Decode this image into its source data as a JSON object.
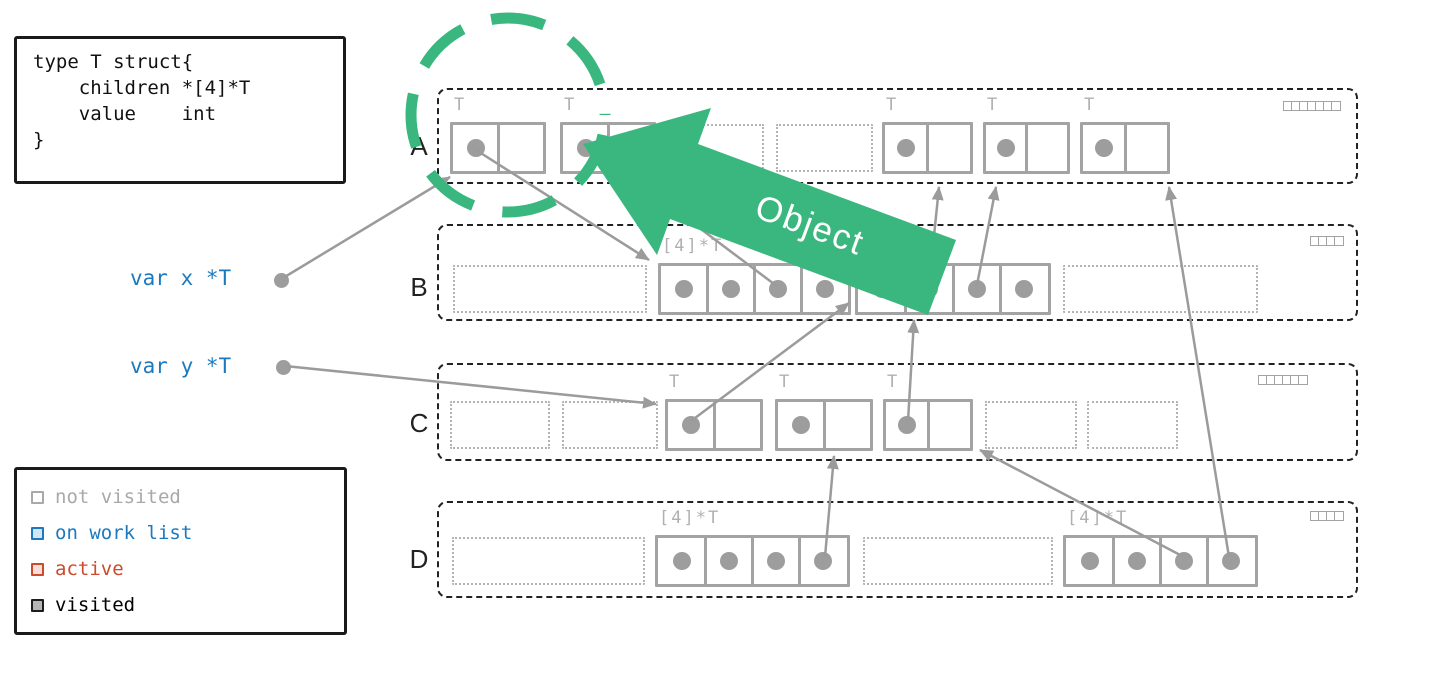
{
  "colors": {
    "green": "#3ab77e",
    "gray_line": "#9b9b9b",
    "gray_box": "#a3a3a3",
    "gray_label": "#b0b0b0",
    "blue": "#1b79c0",
    "red": "#cd4a2d",
    "ink": "#1a1a1a"
  },
  "code_block": {
    "text": "type T struct{\n    children *[4]*T\n    value    int\n}"
  },
  "legend": {
    "items": [
      {
        "label": "not visited",
        "border": "#a9a9a9",
        "fill": "#ffffff",
        "text_color": "#a9a9a9"
      },
      {
        "label": "on work list",
        "border": "#1b79c0",
        "fill": "#d3e4f2",
        "text_color": "#1b79c0"
      },
      {
        "label": "active",
        "border": "#cd4a2d",
        "fill": "#f7ded7",
        "text_color": "#cd4a2d"
      },
      {
        "label": "visited",
        "border": "#1d1d1d",
        "fill": "#b5b5b5",
        "text_color": "#000000"
      }
    ]
  },
  "stack_vars": [
    {
      "label": "var x *T",
      "label_pos": [
        130,
        266
      ],
      "dot": [
        281,
        280
      ]
    },
    {
      "label": "var y *T",
      "label_pos": [
        130,
        354
      ],
      "dot": [
        283,
        367
      ]
    }
  ],
  "object_arrow": {
    "label": "Object",
    "color": "#3ab77e"
  },
  "spans": [
    {
      "id": "A",
      "label": "A",
      "x": 437,
      "y": 88,
      "w": 921,
      "h": 96,
      "obj_y": 122,
      "bitmap_cells": 7,
      "bitmap_pos": [
        1283,
        101
      ],
      "items": [
        {
          "type": "object",
          "label": "T",
          "x": 450,
          "w": 96,
          "cells": 2,
          "dots": [
            0
          ]
        },
        {
          "type": "object",
          "label": "T",
          "x": 560,
          "w": 96,
          "cells": 2,
          "dots": [
            0
          ]
        },
        {
          "type": "free",
          "x": 676,
          "w": 88
        },
        {
          "type": "free",
          "x": 776,
          "w": 97
        },
        {
          "type": "object",
          "label": "T",
          "x": 882,
          "w": 91,
          "cells": 2,
          "dots": [
            0
          ]
        },
        {
          "type": "object",
          "label": "T",
          "x": 983,
          "w": 87,
          "cells": 2,
          "dots": [
            0
          ]
        },
        {
          "type": "object",
          "label": "T",
          "x": 1080,
          "w": 90,
          "cells": 2,
          "dots": [
            0
          ]
        }
      ]
    },
    {
      "id": "B",
      "label": "B",
      "x": 437,
      "y": 224,
      "w": 921,
      "h": 97,
      "obj_y": 263,
      "bitmap_cells": 4,
      "bitmap_pos": [
        1310,
        236
      ],
      "items": [
        {
          "type": "free",
          "x": 453,
          "w": 194
        },
        {
          "type": "object",
          "label": "[4]*T",
          "x": 658,
          "w": 193,
          "cells": 4,
          "dots": [
            0,
            1,
            2,
            3
          ]
        },
        {
          "type": "object",
          "label": "[4]*T",
          "x": 855,
          "w": 196,
          "cells": 4,
          "dots": [
            0,
            1,
            2,
            3
          ]
        },
        {
          "type": "free",
          "x": 1063,
          "w": 195
        }
      ]
    },
    {
      "id": "C",
      "label": "C",
      "x": 437,
      "y": 363,
      "w": 921,
      "h": 98,
      "obj_y": 399,
      "bitmap_cells": 6,
      "bitmap_pos": [
        1258,
        375
      ],
      "items": [
        {
          "type": "free",
          "x": 450,
          "w": 100
        },
        {
          "type": "free",
          "x": 562,
          "w": 96
        },
        {
          "type": "object",
          "label": "T",
          "x": 665,
          "w": 98,
          "cells": 2,
          "dots": [
            0
          ]
        },
        {
          "type": "object",
          "label": "T",
          "x": 775,
          "w": 98,
          "cells": 2,
          "dots": [
            0
          ]
        },
        {
          "type": "object",
          "label": "T",
          "x": 883,
          "w": 90,
          "cells": 2,
          "dots": [
            0
          ]
        },
        {
          "type": "free",
          "x": 985,
          "w": 92
        },
        {
          "type": "free",
          "x": 1087,
          "w": 91
        }
      ]
    },
    {
      "id": "D",
      "label": "D",
      "x": 437,
      "y": 501,
      "w": 921,
      "h": 97,
      "obj_y": 535,
      "bitmap_cells": 4,
      "bitmap_pos": [
        1310,
        511
      ],
      "items": [
        {
          "type": "free",
          "x": 452,
          "w": 193
        },
        {
          "type": "object",
          "label": "[4]*T",
          "x": 655,
          "w": 195,
          "cells": 4,
          "dots": [
            0,
            1,
            2,
            3
          ]
        },
        {
          "type": "free",
          "x": 863,
          "w": 190
        },
        {
          "type": "object",
          "label": "[4]*T",
          "x": 1063,
          "w": 195,
          "cells": 4,
          "dots": [
            0,
            1,
            2,
            3
          ]
        }
      ]
    }
  ],
  "pointers": [
    {
      "name": "var-x-to-A1",
      "line": [
        283,
        278,
        450,
        177
      ]
    },
    {
      "name": "var-y-to-C1",
      "line": [
        285,
        366,
        656,
        404
      ]
    },
    {
      "name": "A1-to-B-array1",
      "line": [
        476,
        150,
        649,
        260
      ]
    },
    {
      "name": "C1-to-B-array2",
      "line": [
        691,
        421,
        849,
        303
      ]
    },
    {
      "name": "B-array1-cell3-to-A2",
      "line": [
        778,
        287,
        633,
        178
      ]
    },
    {
      "name": "C3-to-B-array2",
      "line": [
        908,
        421,
        914,
        320
      ]
    },
    {
      "name": "B-array2-cell2-to-A3",
      "line": [
        929,
        285,
        939,
        187
      ]
    },
    {
      "name": "B-array2-cell3-to-A4",
      "line": [
        977,
        285,
        996,
        187
      ]
    },
    {
      "name": "D-array1-cell4-to-C2",
      "line": [
        825,
        557,
        834,
        456
      ]
    },
    {
      "name": "D-array2-cell3-to-C3",
      "line": [
        1184,
        557,
        980,
        450
      ]
    },
    {
      "name": "D-array2-cell4-to-A5",
      "line": [
        1229,
        557,
        1169,
        187
      ]
    }
  ],
  "gc_circle": {
    "cx": 508,
    "cy": 115,
    "r": 97
  }
}
